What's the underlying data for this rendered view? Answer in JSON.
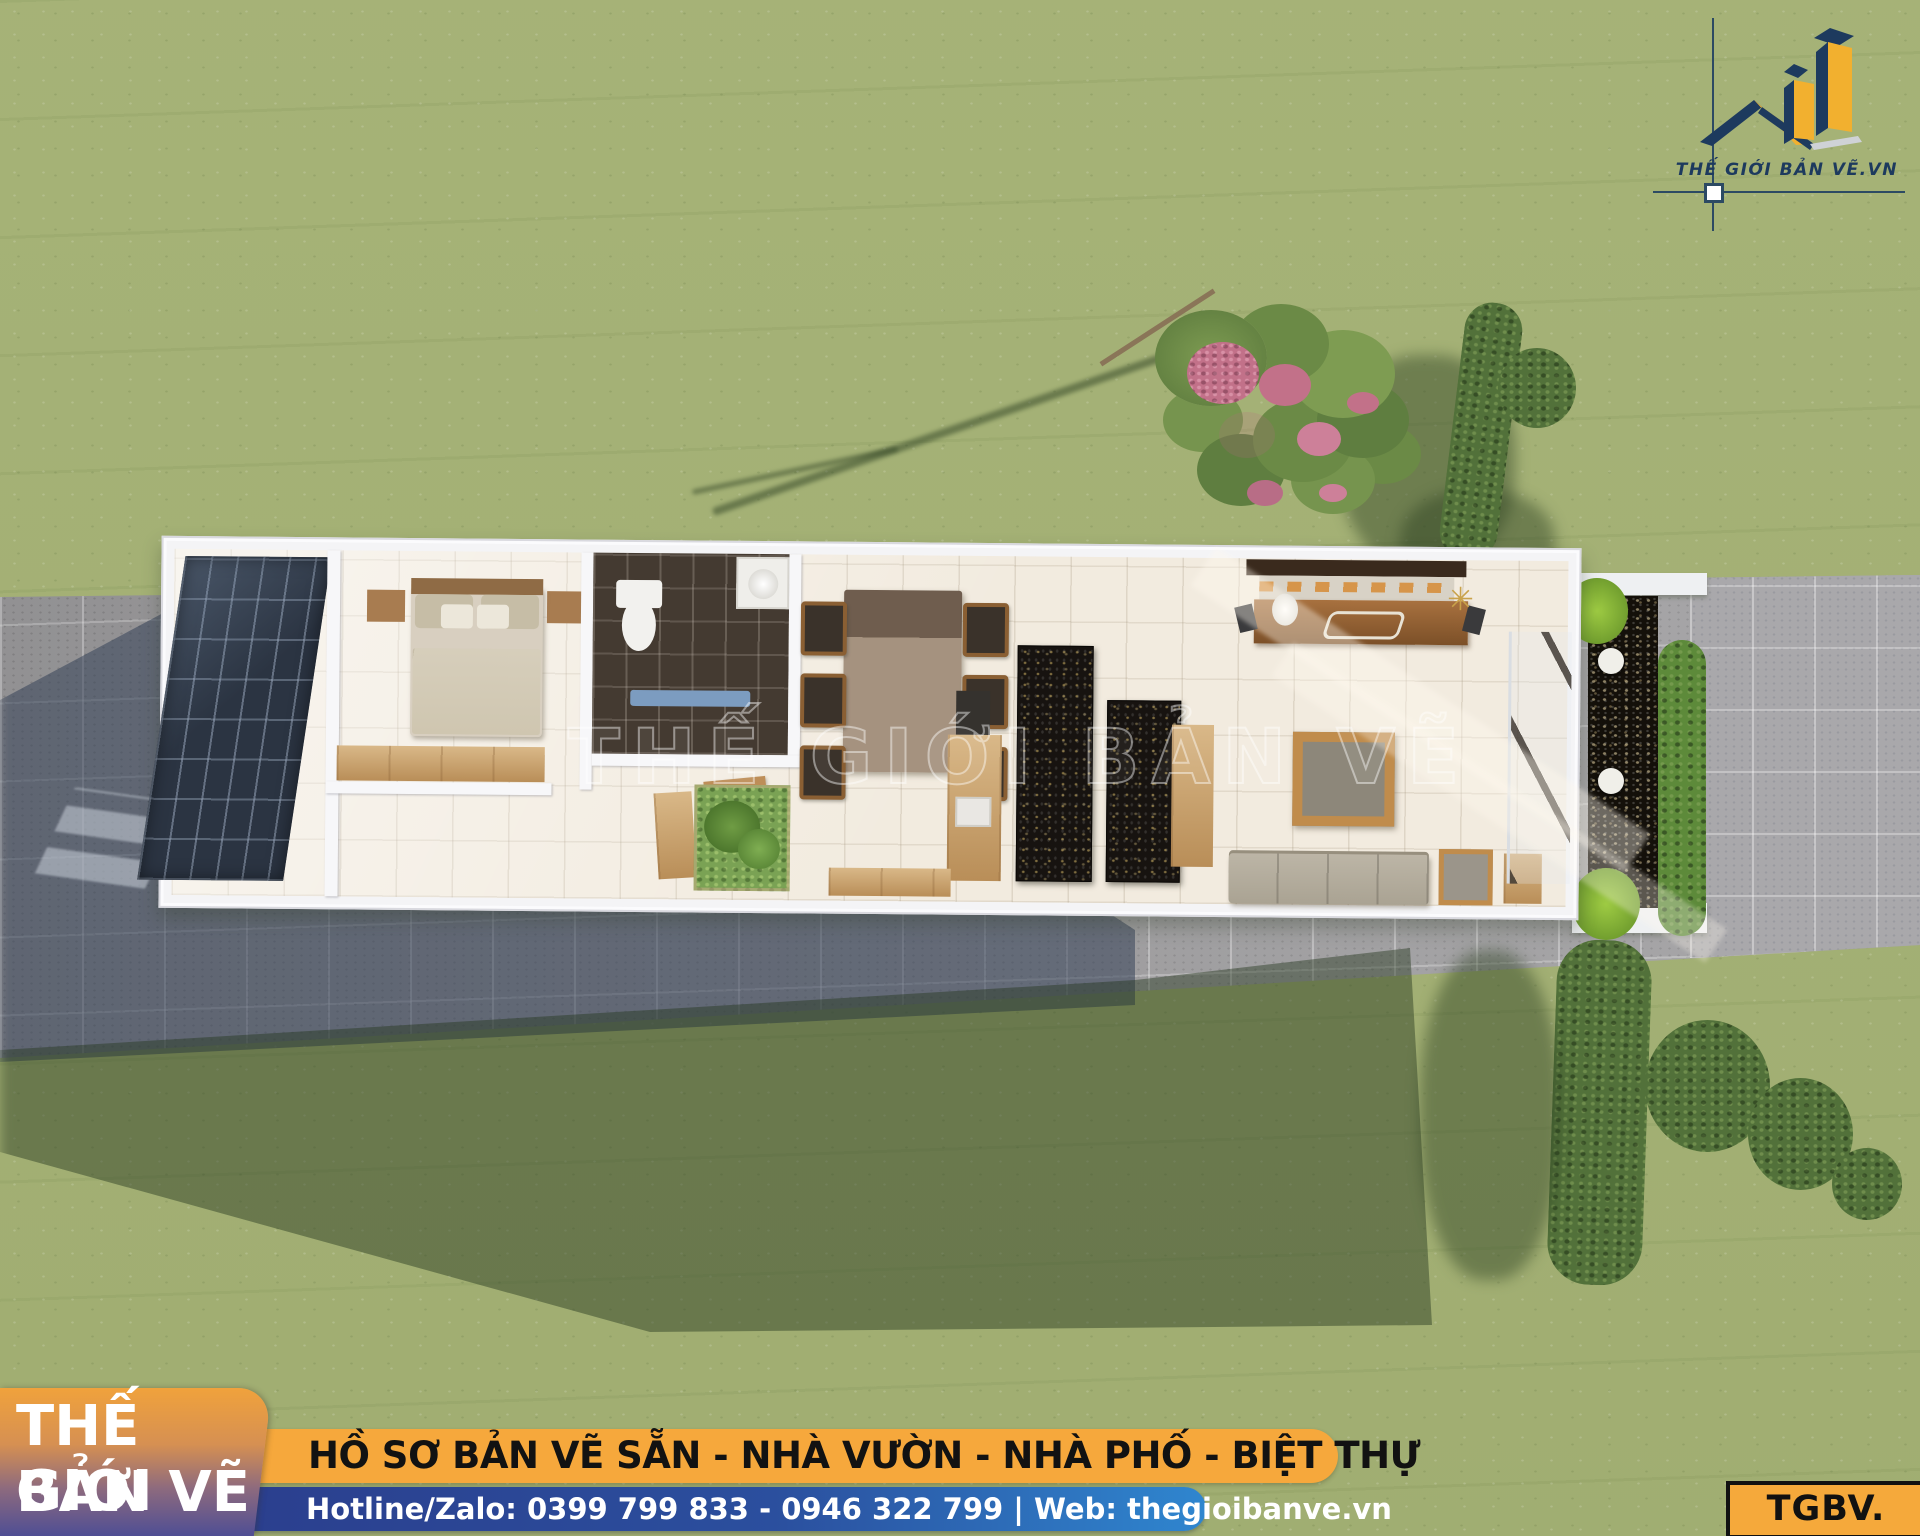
{
  "logo": {
    "text": "THẾ GIỚI BẢN VẼ.VN"
  },
  "watermark": {
    "text": "THẾ GIỚI BẢN VẼ"
  },
  "footer": {
    "brand_line1": "THẾ GIỚI",
    "brand_line2": "BẢN VẼ",
    "services": "HỒ SƠ BẢN VẼ SẴN - NHÀ VƯỜN - NHÀ PHỐ - BIỆT THỰ",
    "contact": "Hotline/Zalo: 0399 799 833 - 0946 322 799 | Web: thegioibanve.vn",
    "code": "TGBV. 1230"
  },
  "colors": {
    "logo_navy": "#1d3a5e",
    "logo_yellow": "#f2b02f",
    "services_bar_bg": "#f6a83c",
    "contact_bar_start": "#2b3f8e",
    "contact_bar_end": "#2f86cf",
    "brand_box_top": "#f0a23c",
    "brand_box_bottom": "#4f4e94",
    "code_badge_bg": "#f5a93b"
  }
}
